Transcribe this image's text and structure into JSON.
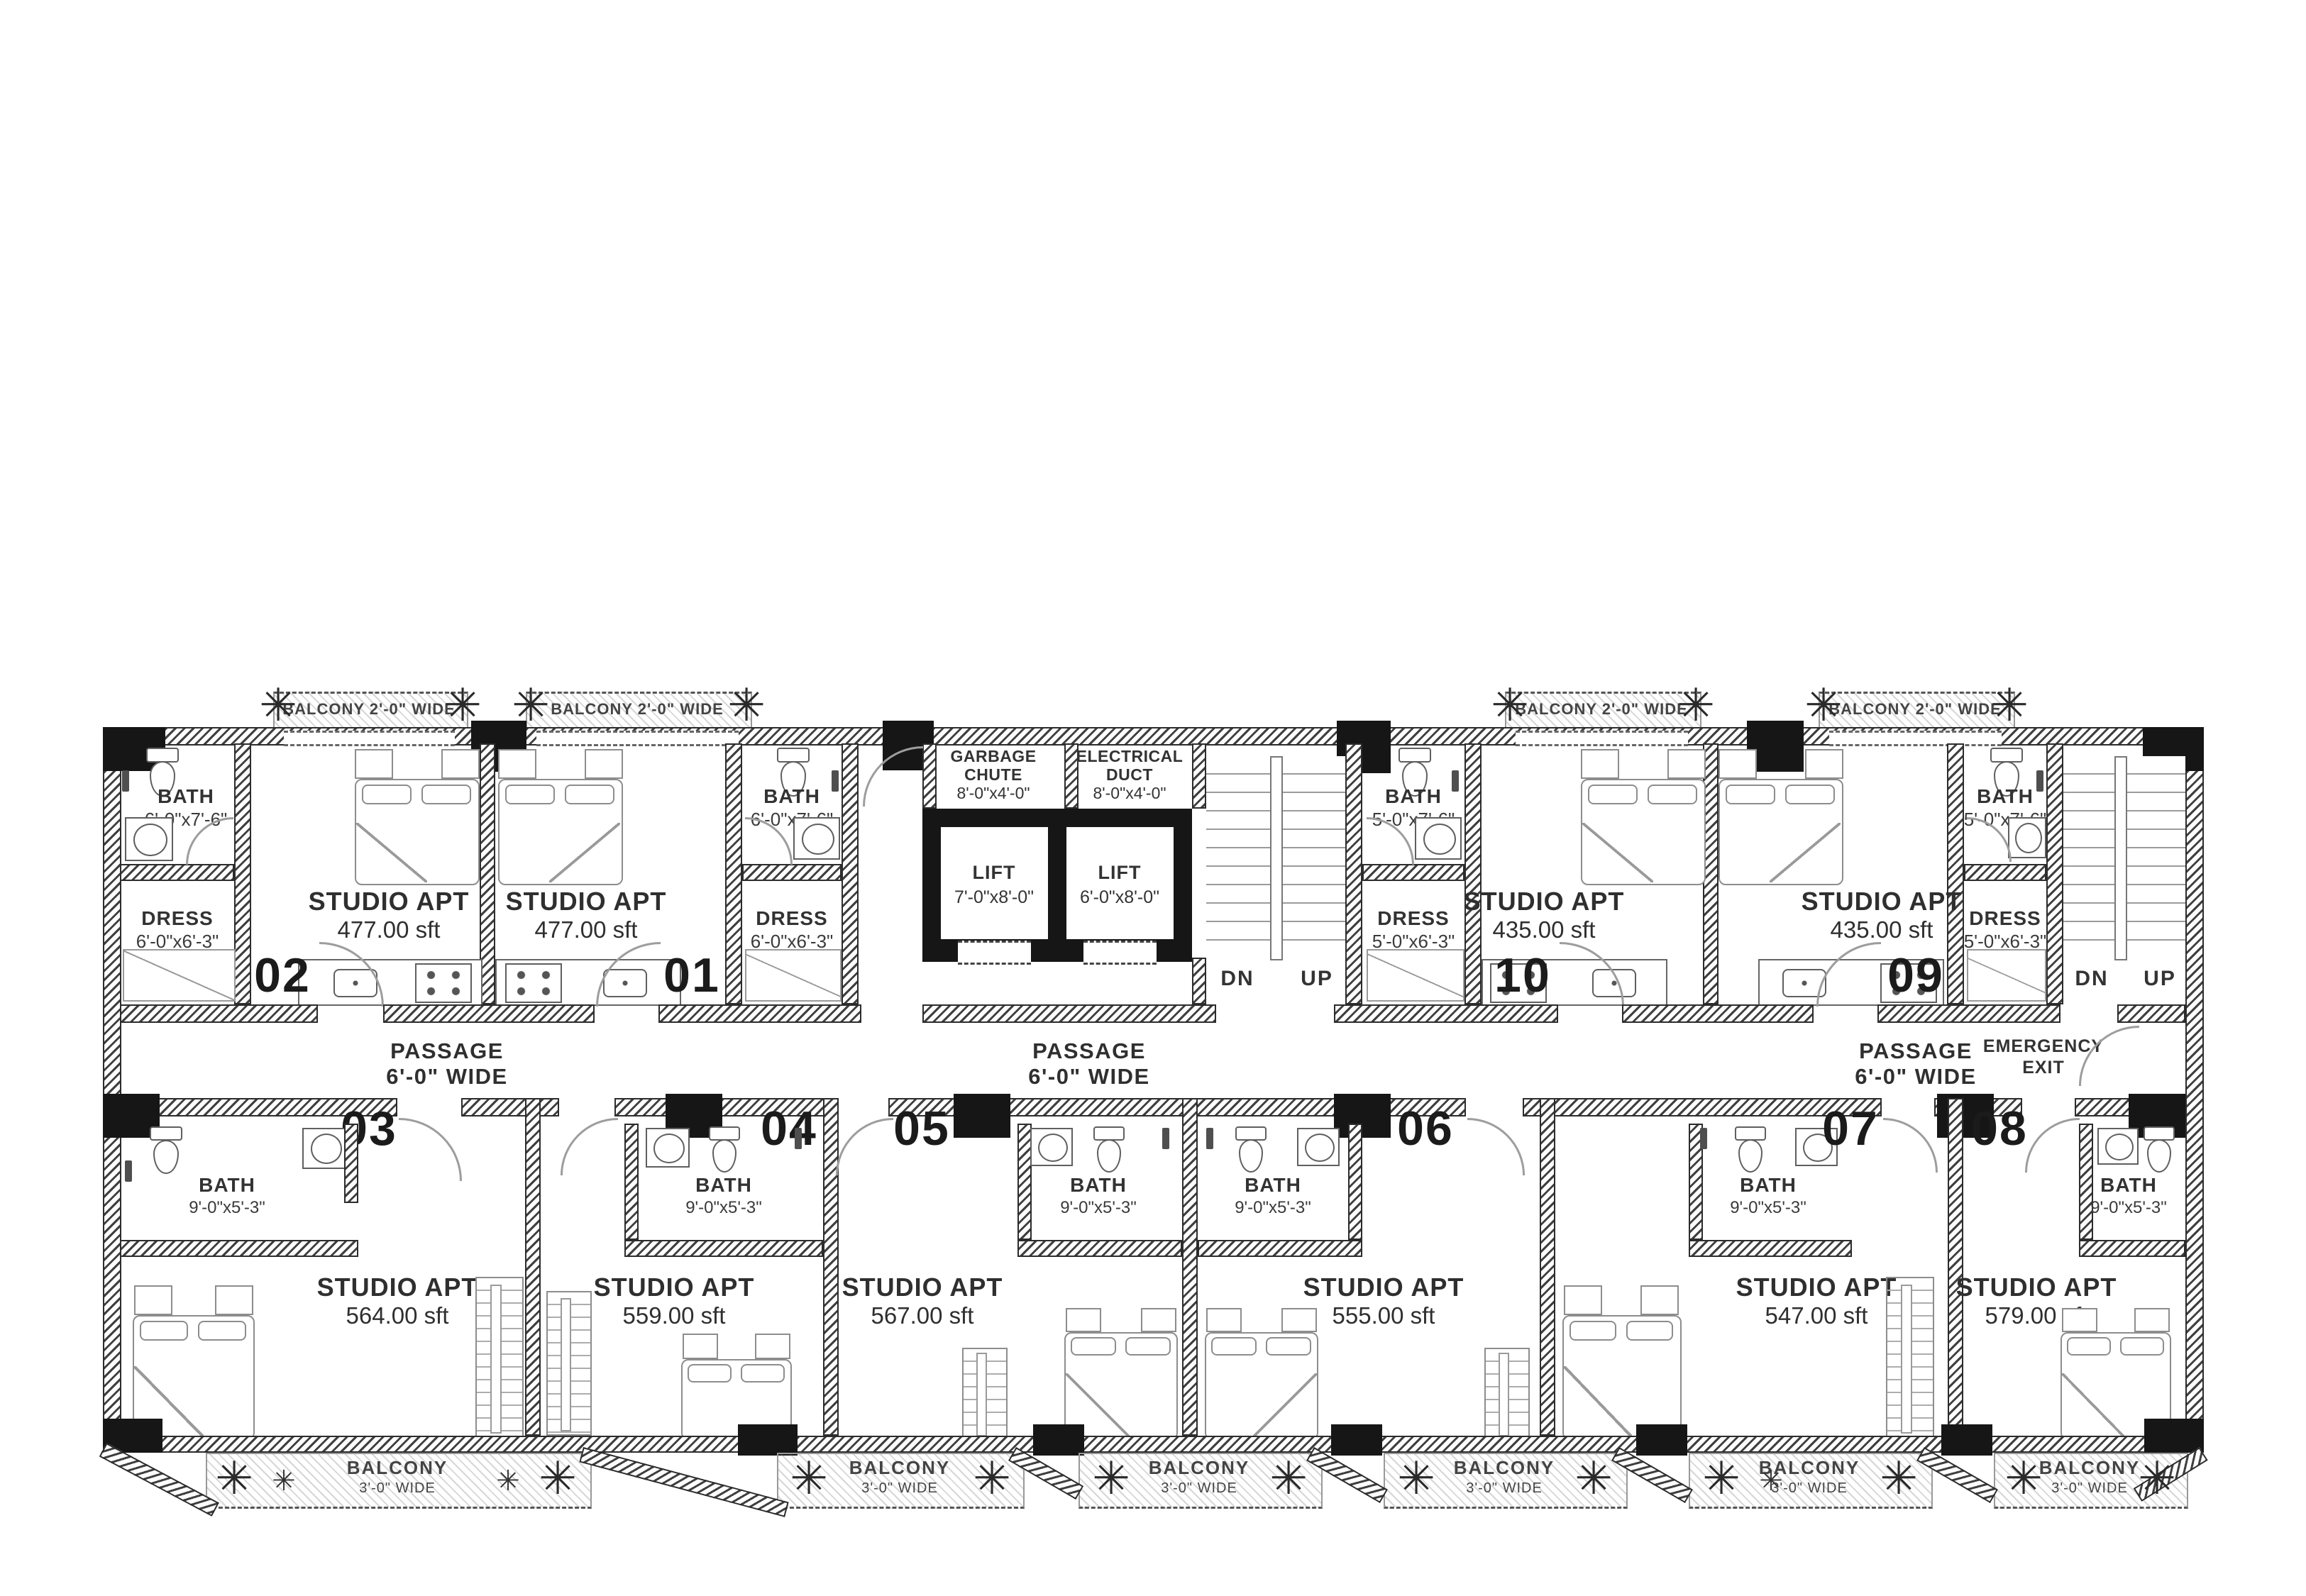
{
  "passage": {
    "line1": "PASSAGE",
    "line2": "6'-0\" WIDE"
  },
  "stairs": {
    "dn": "DN",
    "up": "UP"
  },
  "emergency_exit": {
    "line1": "EMERGENCY",
    "line2": "EXIT"
  },
  "balcony_top": {
    "label": "BALCONY 2'-0\" WIDE"
  },
  "balcony_bottom": {
    "line1": "BALCONY",
    "line2": "3'-0\" WIDE"
  },
  "core": {
    "garbage_chute": {
      "line1": "GARBAGE",
      "line2": "CHUTE",
      "size": "8'-0\"x4'-0\""
    },
    "electrical_duct": {
      "line1": "ELECTRICAL",
      "line2": "DUCT",
      "size": "8'-0\"x4'-0\""
    },
    "lift_a": {
      "name": "LIFT",
      "size": "7'-0\"x8'-0\""
    },
    "lift_b": {
      "name": "LIFT",
      "size": "6'-0\"x8'-0\""
    }
  },
  "units": {
    "u01": {
      "number": "01",
      "type": "STUDIO APT",
      "area": "477.00 sft",
      "bath_name": "BATH",
      "bath_size": "6'-0\"x7'-6\"",
      "dress_name": "DRESS",
      "dress_size": "6'-0\"x6'-3\""
    },
    "u02": {
      "number": "02",
      "type": "STUDIO APT",
      "area": "477.00 sft",
      "bath_name": "BATH",
      "bath_size": "6'-0\"x7'-6\"",
      "dress_name": "DRESS",
      "dress_size": "6'-0\"x6'-3\""
    },
    "u03": {
      "number": "03",
      "type": "STUDIO APT",
      "area": "564.00 sft",
      "bath_name": "BATH",
      "bath_size": "9'-0\"x5'-3\""
    },
    "u04": {
      "number": "04",
      "type": "STUDIO APT",
      "area": "559.00 sft",
      "bath_name": "BATH",
      "bath_size": "9'-0\"x5'-3\""
    },
    "u05": {
      "number": "05",
      "type": "STUDIO APT",
      "area": "567.00 sft",
      "bath_name": "BATH",
      "bath_size": "9'-0\"x5'-3\""
    },
    "u06": {
      "number": "06",
      "type": "STUDIO APT",
      "area": "555.00 sft",
      "bath_name": "BATH",
      "bath_size": "9'-0\"x5'-3\""
    },
    "u07": {
      "number": "07",
      "type": "STUDIO APT",
      "area": "547.00 sft",
      "bath_name": "BATH",
      "bath_size": "9'-0\"x5'-3\""
    },
    "u08": {
      "number": "08",
      "type": "STUDIO APT",
      "area": "579.00 sft",
      "bath_name": "BATH",
      "bath_size": "9'-0\"x5'-3\""
    },
    "u09": {
      "number": "09",
      "type": "STUDIO APT",
      "area": "435.00 sft",
      "bath_name": "BATH",
      "bath_size": "5'-0\"x7'-6\"",
      "dress_name": "DRESS",
      "dress_size": "5'-0\"x6'-3\""
    },
    "u10": {
      "number": "10",
      "type": "STUDIO APT",
      "area": "435.00 sft",
      "bath_name": "BATH",
      "bath_size": "5'-0\"x7'-6\"",
      "dress_name": "DRESS",
      "dress_size": "5'-0\"x6'-3\""
    }
  }
}
